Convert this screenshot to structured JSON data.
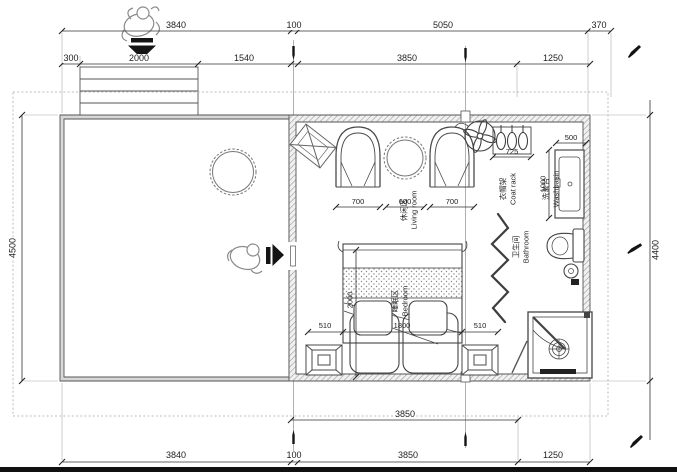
{
  "plan": {
    "title": "floor-plan",
    "labels": {
      "living": {
        "zh": "休闲区",
        "en": "Living room"
      },
      "bedroom": {
        "zh": "睡眠区",
        "en": "Bedroom"
      },
      "bathroom": {
        "zh": "卫生间",
        "en": "Bathroom"
      },
      "washbasin": {
        "zh": "洗漱台",
        "en": "Washbasin"
      },
      "coat_rack": {
        "zh": "衣帽架",
        "en": "Coat rack"
      }
    },
    "dims": {
      "top1": [
        "3840",
        "100",
        "5050",
        "370"
      ],
      "top2": [
        "300",
        "2000",
        "1540",
        "3850",
        "1250"
      ],
      "bottom1": [
        "3850"
      ],
      "bottom2": [
        "3840",
        "100",
        "3850",
        "1250"
      ],
      "left": "4500",
      "right": "4400",
      "furniture": [
        "700",
        "600",
        "700"
      ],
      "coat_rack_w": "725",
      "basin_w": "500",
      "basin_d": "1000",
      "bed": [
        "510",
        "1800",
        "510"
      ],
      "bed_len": "2000"
    },
    "icons": {
      "entry_top": "person-walking-icon",
      "entry_top_arrow": "arrow-down-icon",
      "entry_side": "person-walking-icon",
      "entry_side_arrow": "arrow-right-icon",
      "fan": "ceiling-fan-icon",
      "marker": "pen-marker-icon"
    },
    "colors": {
      "line": "#444444",
      "wall_fill": "#d8d8d8",
      "boundary": "#bbbbbb",
      "marker": "#111111",
      "bottom_bar": "#101010"
    }
  }
}
